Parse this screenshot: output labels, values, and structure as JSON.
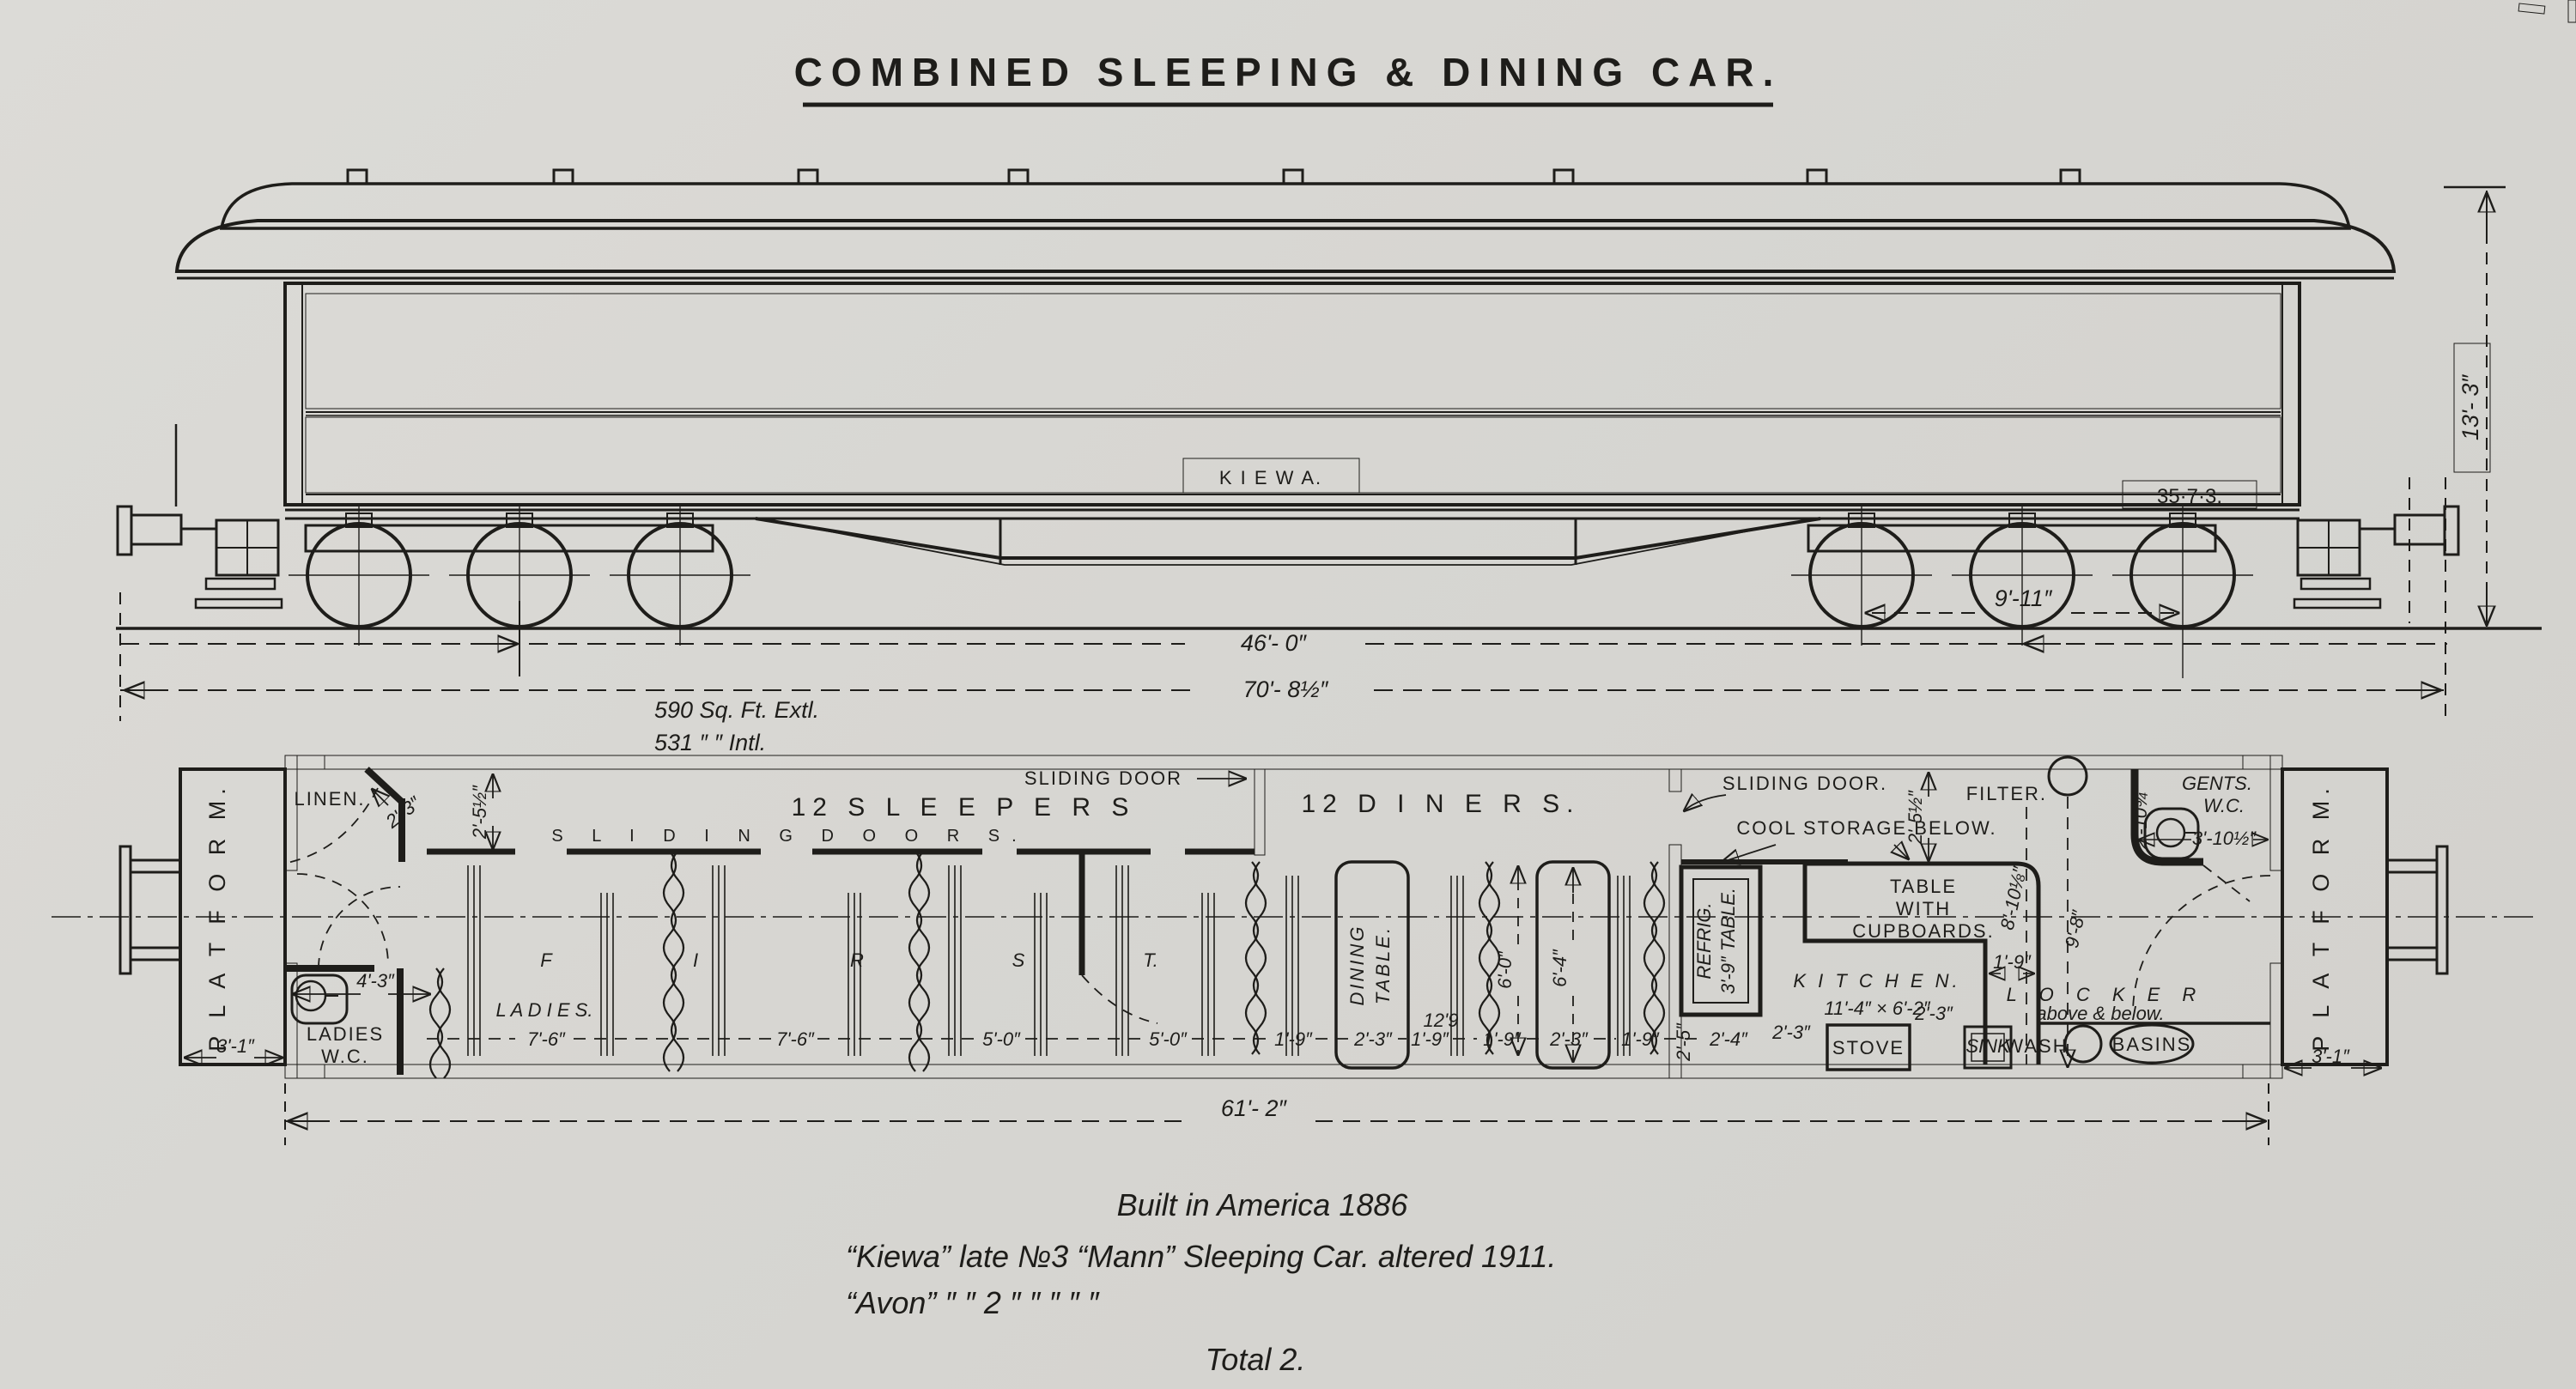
{
  "title": "COMBINED SLEEPING & DINING CAR.",
  "elevation": {
    "car_name": "K I E W A.",
    "weight_code": "35·7·3.",
    "area_line1": "590   Sq. Ft.  Extl.",
    "area_line2": "531       ″         ″       Intl.",
    "dims": {
      "bogie_wheelbase": "9'-11″",
      "bogie_centres": "46'- 0″",
      "length_over_buffers": "70'- 8½″",
      "height": "13'- 3″"
    }
  },
  "plan": {
    "platform_left": "P L A T F O R M.",
    "platform_right": "P L A T F O R M.",
    "linen": "LINEN.",
    "ladies_wc_line1": "LADIES",
    "ladies_wc_line2": "W.C.",
    "sleepers": "12  S L E E P E R S",
    "sliding_door_sleepers": "SLIDING DOOR",
    "sliding_doors_spread": "S L I D I N G      D O O R S.",
    "first_letters": [
      "F",
      "I",
      "R",
      "S",
      "T."
    ],
    "ladies_spread": "L A D I E S.",
    "diners": "12   D I N E R S.",
    "dining_table_line1": "DINING",
    "dining_table_line2": "TABLE.",
    "sliding_door_kitchen": "SLIDING DOOR.",
    "cool_storage": "COOL STORAGE BELOW.",
    "refrig": "REFRIG.",
    "refrig_table": "3'-9″ TABLE.",
    "cupboards_line1": "TABLE",
    "cupboards_line2": "WITH",
    "cupboards_line3": "CUPBOARDS.",
    "kitchen_line1": "K I T C H E N.",
    "kitchen_line2": "11'-4″ × 6'-2″",
    "stove": "STOVE",
    "sink": "SINK",
    "filter": "FILTER.",
    "gents_line1": "GENTS.",
    "gents_line2": "W.C.",
    "locker_line1": "L O C K E R",
    "locker_line2": "above & below.",
    "wash": "WASH",
    "basins": "BASINS",
    "dims": {
      "d2_3": "2'-3″",
      "d2_5h": "2'-5½″",
      "d4_3": "4'-3″",
      "d3_1": "3'-1″",
      "d7_6": "7'-6″",
      "d5_0": "5'-0″",
      "d1_9": "1'-9″",
      "d12_9": "12'9",
      "d6_0": "6'-0″",
      "d6_4": "6'-4″",
      "d2_4": "2'-4″",
      "d2_5": "2'-5″",
      "d8_10": "8'-10⅛″",
      "d9_8": "9'-8″",
      "d2_10": "2'-10¾″",
      "d3_10h": "3'-10½″",
      "d61_2": "61'- 2″"
    }
  },
  "footer": {
    "line1": "Built in America 1886",
    "line2": "“Kiewa” late №3 “Mann”  Sleeping Car. altered 1911.",
    "line3": "“Avon”    ″    ″ 2    ″            ″            ″      ″      ″",
    "line4": "Total   2."
  }
}
